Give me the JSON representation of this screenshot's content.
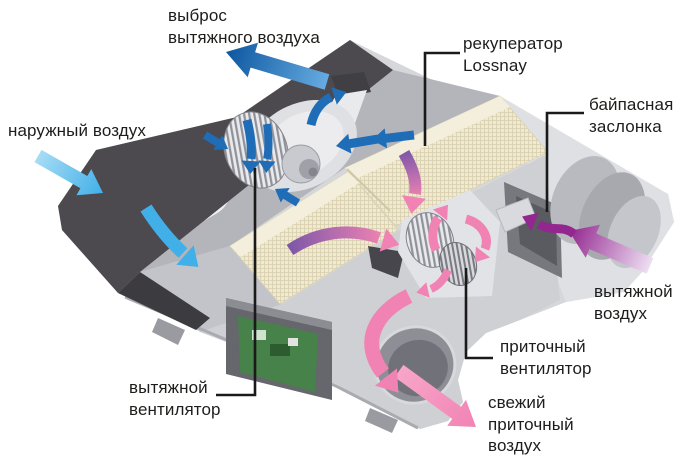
{
  "diagram": {
    "labels": {
      "exhaust_discharge": "выброс\nвытяжного воздуха",
      "recuperator": "рекуператор\nLossnay",
      "bypass_damper": "байпасная\nзаслонка",
      "outdoor_air": "наружный воздух",
      "extract_air": "вытяжной\nвоздух",
      "supply_fan": "приточный\nвентилятор",
      "exhaust_fan": "вытяжной\nвентилятор",
      "fresh_supply_air": "свежий\nприточный\nвоздух"
    },
    "colors": {
      "label_text": "#1d1d1b",
      "leader_line": "#1a1a1a",
      "exhaust_blue_dark": "#0d57a0",
      "exhaust_blue_light": "#66abe0",
      "outdoor_blue": "#41b0e8",
      "flow_blue": "#1e6db6",
      "supply_pink": "#f183b4",
      "supply_pink_light": "#f7a6c9",
      "extract_purple": "#93278f",
      "extract_purple_light": "#eddff2",
      "flow_purple": "#7e57a8",
      "casing_dark": "#4c4a4f",
      "body_gray": "#d6d7da",
      "core_cream": "#f0ead3"
    }
  }
}
